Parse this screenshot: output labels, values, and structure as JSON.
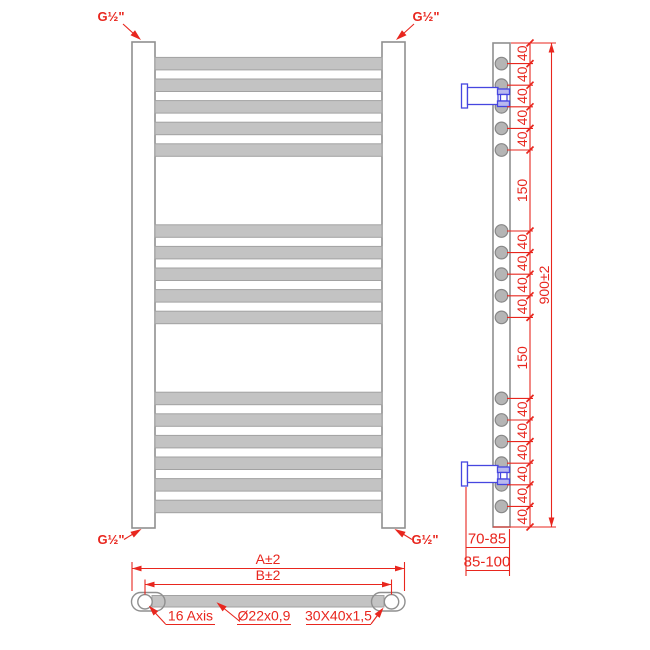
{
  "colors": {
    "red": "#e8261e",
    "blue": "#4646e0",
    "blue-fill": "#b9b9ef",
    "metal": "#c3c3c3",
    "metal-edge": "#a2a2a2",
    "outline": "#8f8f8f",
    "hole-fill": "#b5b5b5"
  },
  "front_view": {
    "port_top_left": "G½\"",
    "port_top_right": "G½\"",
    "port_bottom_left": "G½\"",
    "port_bottom_right": "G½\""
  },
  "side_view": {
    "chain": [
      "40",
      "40",
      "40",
      "40",
      "40",
      "150",
      "40",
      "40",
      "40",
      "40",
      "150",
      "40",
      "40",
      "40",
      "40",
      "40",
      "40"
    ],
    "overall_height": "900±2",
    "wall_clearance_min": "70-85",
    "wall_clearance_max": "85-100"
  },
  "top_view": {
    "overall_width": "A±2",
    "center_distance": "B±2",
    "axis_note": "16 Axis",
    "rung_tube_spec": "Ø22x0,9",
    "profile_spec": "30X40x1,5"
  }
}
